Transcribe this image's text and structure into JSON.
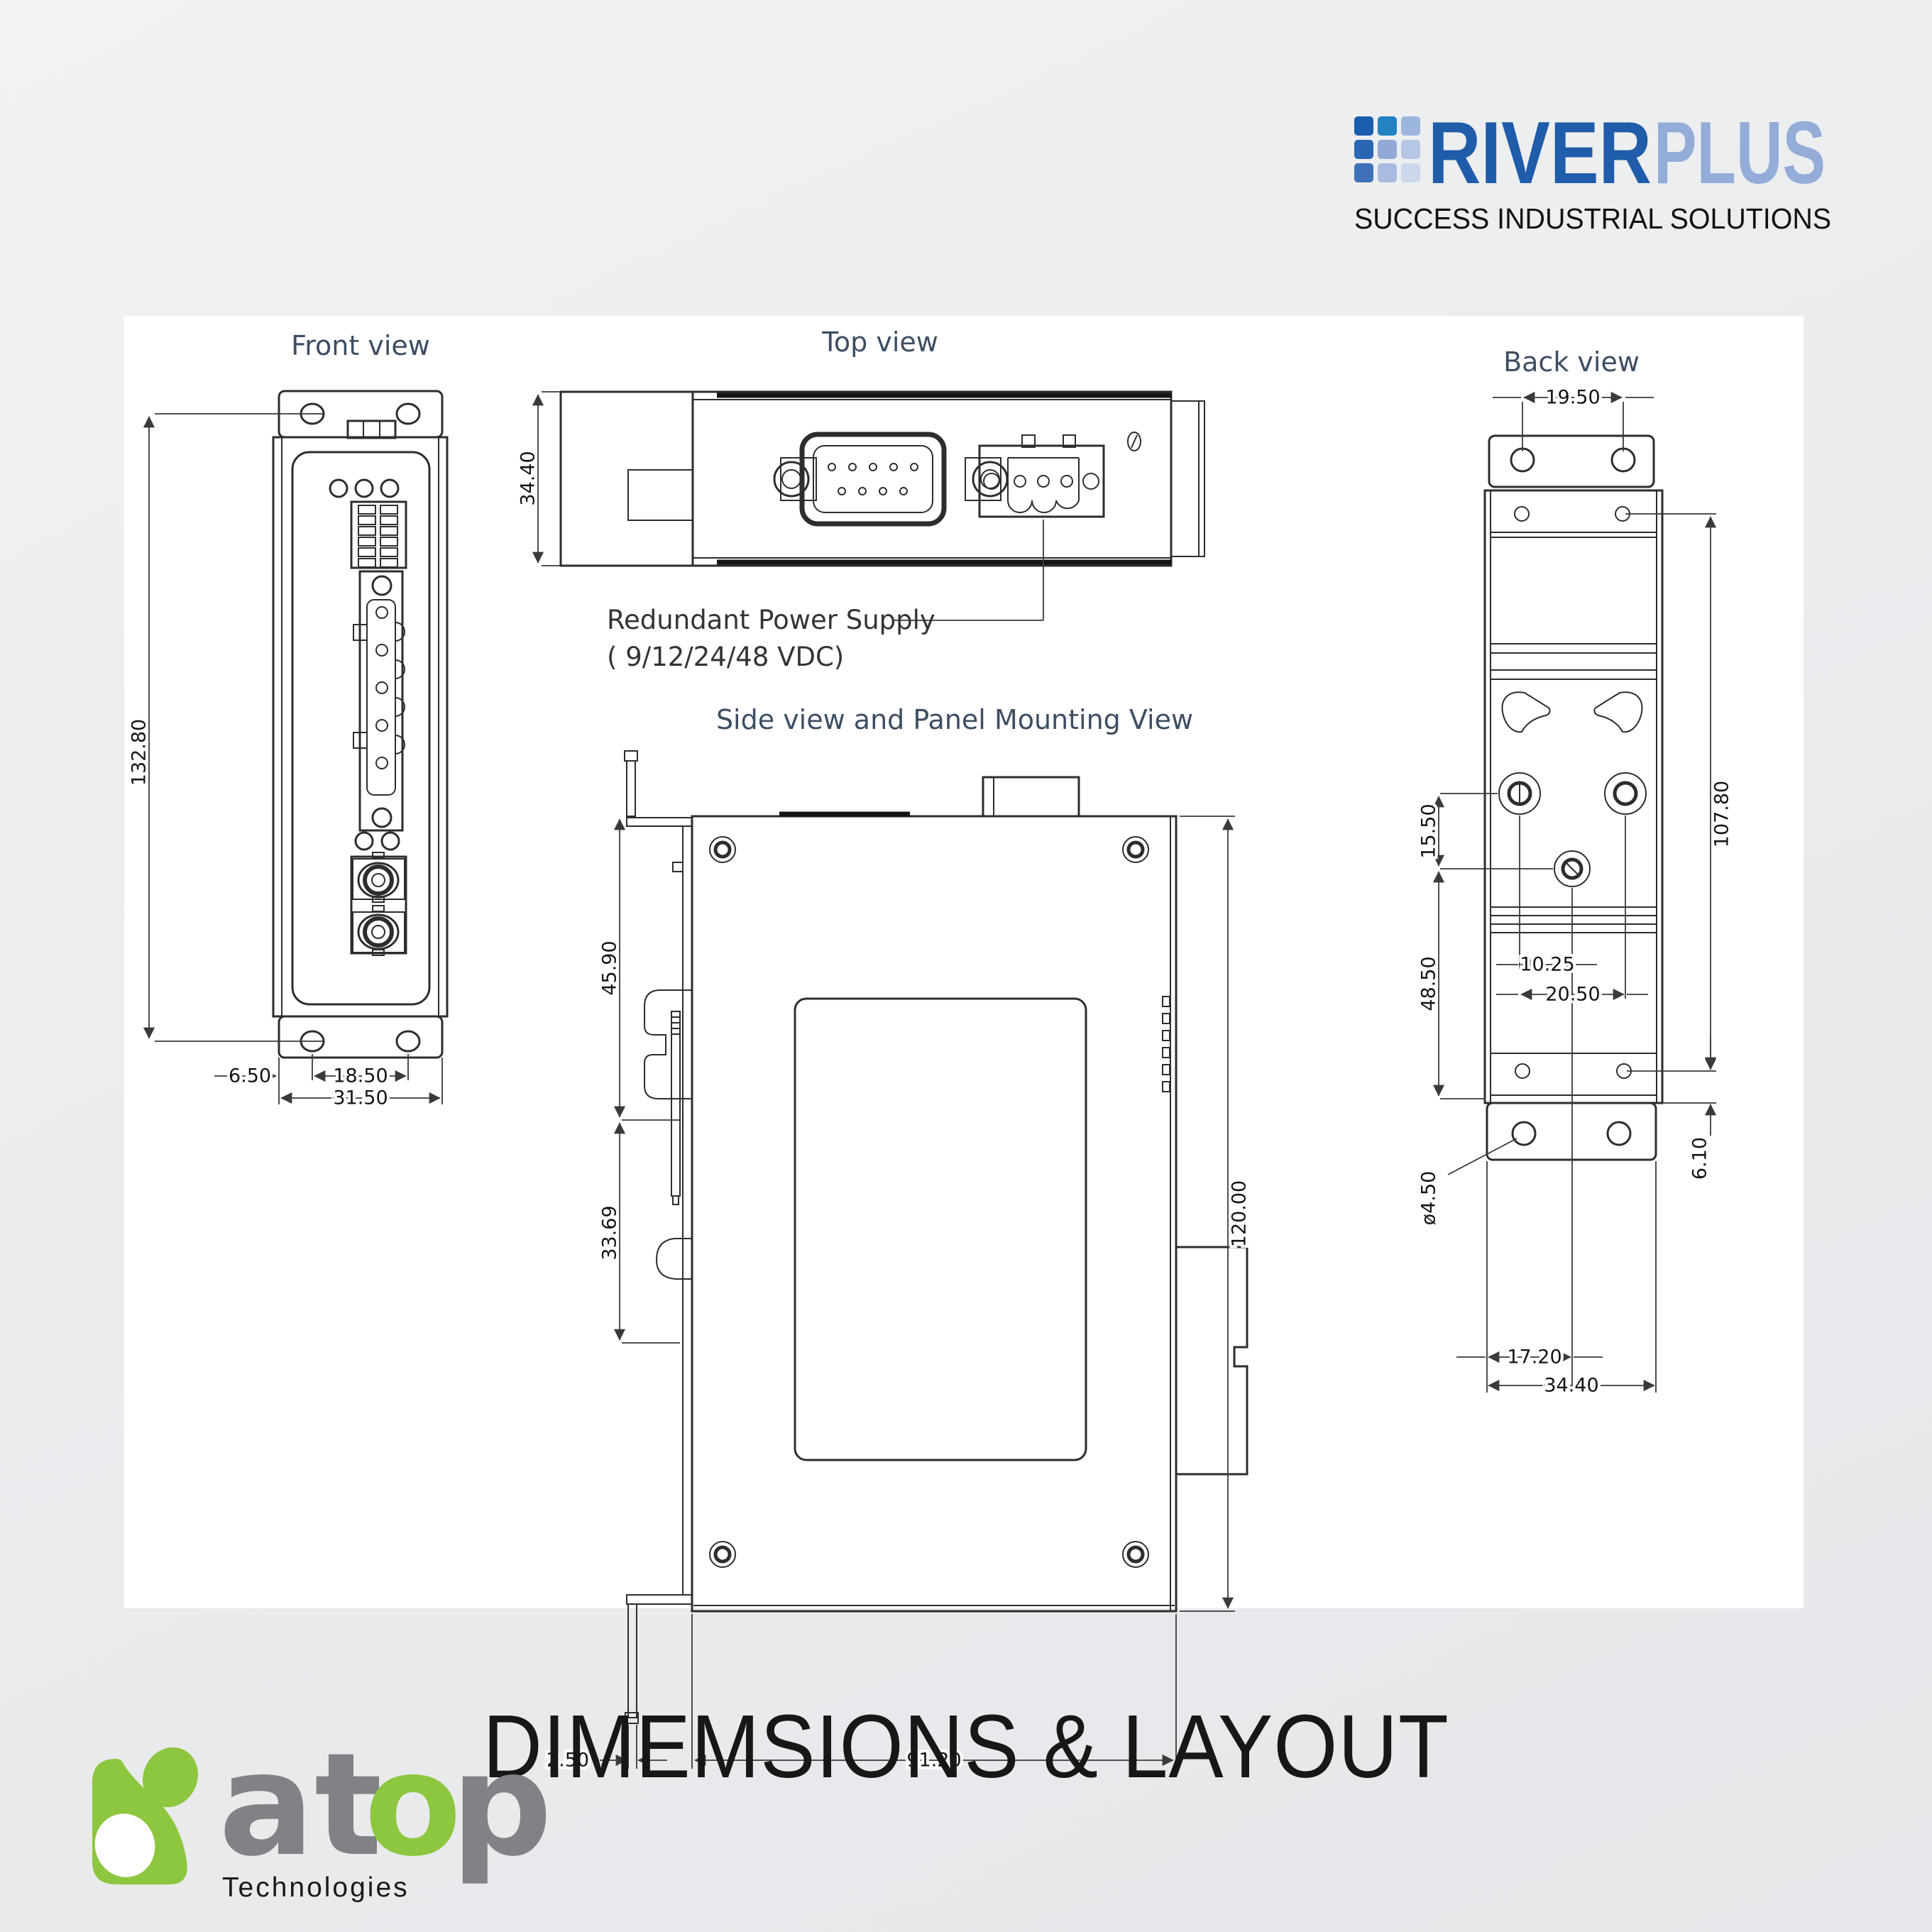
{
  "colors": {
    "background": "#ebedee",
    "panel": "#ffffff",
    "line": "#2d2d2d",
    "view_title": "#3d4e63",
    "river_dark": "#1f5ca9",
    "river_light": "#93acd8",
    "atop_green": "#8dc63f",
    "atop_gray": "#808285"
  },
  "header": {
    "brand": {
      "word_primary": "RIVER",
      "word_secondary": "PLUS",
      "tagline": "SUCCESS INDUSTRIAL SOLUTIONS",
      "grid_colors": [
        "#1a5dad",
        "#2282c2",
        "#9cb5dd",
        "#2b66b2",
        "#93a9d5",
        "#b6c6e5",
        "#3e71b8",
        "#a9bce0",
        "#ccd7ec"
      ]
    }
  },
  "drawing": {
    "front_view": {
      "title": "Front view",
      "dims": {
        "height": "132.80",
        "edge_offset": "6.50",
        "hole_spacing": "18.50",
        "width": "31.50"
      }
    },
    "top_view": {
      "title": "Top view",
      "dims": {
        "depth": "34.40"
      },
      "annotation": {
        "line1": "Redundant Power Supply",
        "line2": "( 9/12/24/48 VDC)"
      }
    },
    "side_view": {
      "title": "Side view and Panel Mounting View",
      "dims": {
        "upper_section": "45.90",
        "lower_section": "33.69",
        "height": "120.00",
        "plate_thickness": "2.50",
        "width": "91.20"
      }
    },
    "back_view": {
      "title": "Back view",
      "dims": {
        "top_hole_spacing": "19.50",
        "mount_height": "107.80",
        "screw_offset": "15.50",
        "lower_section": "48.50",
        "half_spacing": "10.25",
        "screw_spacing": "20.50",
        "bottom_gap": "6.10",
        "hole_diameter": "ø4.50",
        "center_offset": "17.20",
        "width": "34.40"
      }
    }
  },
  "footer": {
    "title": "DIMEMSIONS & LAYOUT"
  },
  "brand_footer": {
    "word_a": "at",
    "word_o": "o",
    "word_p": "p",
    "tagline": "Technologies"
  }
}
